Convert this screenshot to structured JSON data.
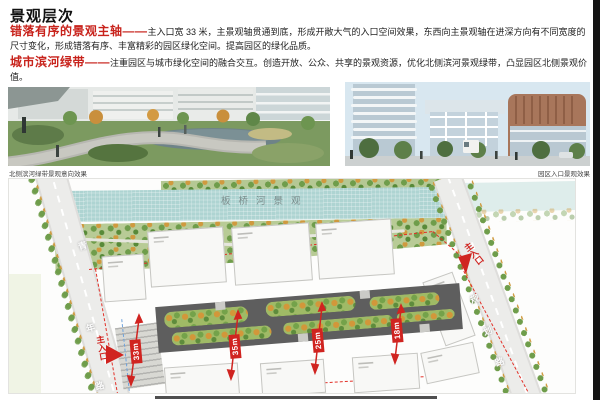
{
  "header": {
    "title": "景观层次"
  },
  "paragraphs": [
    {
      "lead": "错落有序的景观主轴——",
      "body": "主入口宽 33 米，主景观轴贯通到底，形成开敞大气的入口空间效果，东西向主景观轴在进深方向有不同宽度的尺寸变化，形成错落有序、丰富精彩的园区绿化空间。提高园区的绿化品质。"
    },
    {
      "lead": "城市滨河绿带——",
      "body": "注重园区与城市绿化空间的融合交互。创造开放、公众、共享的景观资源，优化北侧滨河景观绿带，凸显园区北侧景观价值。"
    }
  ],
  "photos": {
    "left_caption": "北侧滨河绿带景观意向效果",
    "right_caption": "园区入口景观效果"
  },
  "plan": {
    "river_label": "板桥河景观",
    "left_road_chars": [
      "青",
      "年",
      "路"
    ],
    "right_road_chars": [
      "规",
      "划",
      "路"
    ],
    "entrance_label": "主入口",
    "dimensions": [
      "33m",
      "35m",
      "25m",
      "18m"
    ]
  },
  "colors": {
    "accent_red": "#d02420",
    "river": "#aed4d2",
    "axis_gray": "#5e5e5e",
    "island_green": "#9fba66",
    "edge_bar": "#141414"
  }
}
